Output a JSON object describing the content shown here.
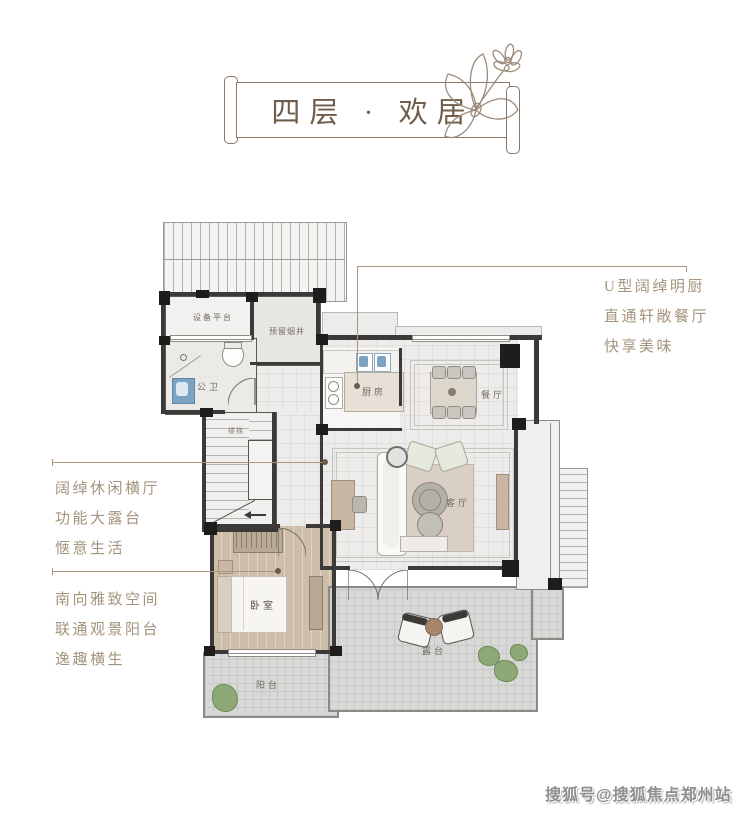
{
  "banner": {
    "title": "四层 · 欢居"
  },
  "annotations": {
    "right_kitchen": {
      "lines": [
        "U型阔绰明厨",
        "直通轩敞餐厅",
        "快享美味"
      ]
    },
    "left_terrace": {
      "lines": [
        "阔绰休闲横厅",
        "功能大露台",
        "惬意生活"
      ]
    },
    "left_bedroom": {
      "lines": [
        "南向雅致空间",
        "联通观景阳台",
        "逸趣横生"
      ]
    }
  },
  "floorplan": {
    "rooms": [
      {
        "id": "equipment-platform",
        "label": "设备平台"
      },
      {
        "id": "reserved-shaft",
        "label": "预留烟井"
      },
      {
        "id": "public-bathroom",
        "label": "公卫"
      },
      {
        "id": "stairs",
        "label": "楼梯"
      },
      {
        "id": "kitchen",
        "label": "厨房"
      },
      {
        "id": "dining-room",
        "label": "餐厅"
      },
      {
        "id": "living-room",
        "label": "客厅"
      },
      {
        "id": "bedroom",
        "label": "卧室"
      },
      {
        "id": "balcony",
        "label": "阳台"
      },
      {
        "id": "terrace",
        "label": "露台"
      }
    ]
  },
  "watermark": {
    "text": "搜狐号@搜狐焦点郑州站"
  },
  "colors": {
    "banner_outline": "#8b7866",
    "annotation_text": "#a4937e",
    "wall": "#3b3a38",
    "sink_blue": "#7ba3c4",
    "plant_green": "#8ea876",
    "wood_floor": "#cdbda9"
  }
}
